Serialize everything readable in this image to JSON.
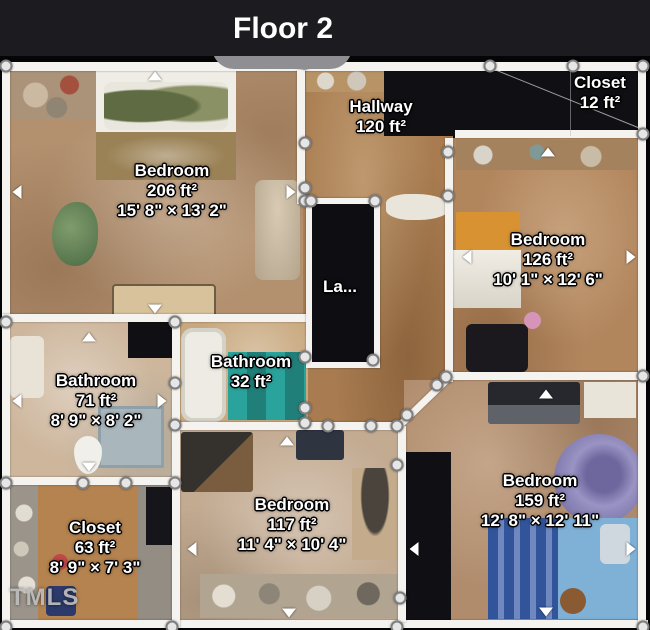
{
  "header": {
    "title": "Floor 2"
  },
  "watermark": "TMLS",
  "rooms": {
    "bedroom_206": {
      "name": "Bedroom",
      "area": "206 ft²",
      "dims": "15' 8\" × 13' 2\""
    },
    "hallway": {
      "name": "Hallway",
      "area": "120 ft²",
      "dims": ""
    },
    "closet_12": {
      "name": "Closet",
      "area": "12 ft²",
      "dims": ""
    },
    "bedroom_126": {
      "name": "Bedroom",
      "area": "126 ft²",
      "dims": "10' 1\" × 12' 6\""
    },
    "laundry": {
      "name": "La...",
      "area": "",
      "dims": ""
    },
    "bathroom_32": {
      "name": "Bathroom",
      "area": "32 ft²",
      "dims": ""
    },
    "bathroom_71": {
      "name": "Bathroom",
      "area": "71 ft²",
      "dims": "8' 9\" × 8' 2\""
    },
    "closet_63": {
      "name": "Closet",
      "area": "63 ft²",
      "dims": "8' 9\" × 7' 3\""
    },
    "bedroom_117": {
      "name": "Bedroom",
      "area": "117 ft²",
      "dims": "11' 4\" × 10' 4\""
    },
    "bedroom_159": {
      "name": "Bedroom",
      "area": "159 ft²",
      "dims": "12' 8\" × 12' 11\""
    }
  },
  "colors": {
    "background": "#000000",
    "titlebar": "#1c1c20",
    "wall": "#f5f3ef",
    "unscanned": "#101014",
    "label_text": "#ffffff",
    "label_outline": "#000000",
    "handle_fill": "#e6e6e6",
    "handle_ring": "#7f7f7f",
    "tab": "#8f8f93",
    "floor_carpet_tan": "#b3916f",
    "floor_wood": "#a87c50",
    "rug_teal": "#2aa39c",
    "bed_blue": "#7fb0d6"
  }
}
